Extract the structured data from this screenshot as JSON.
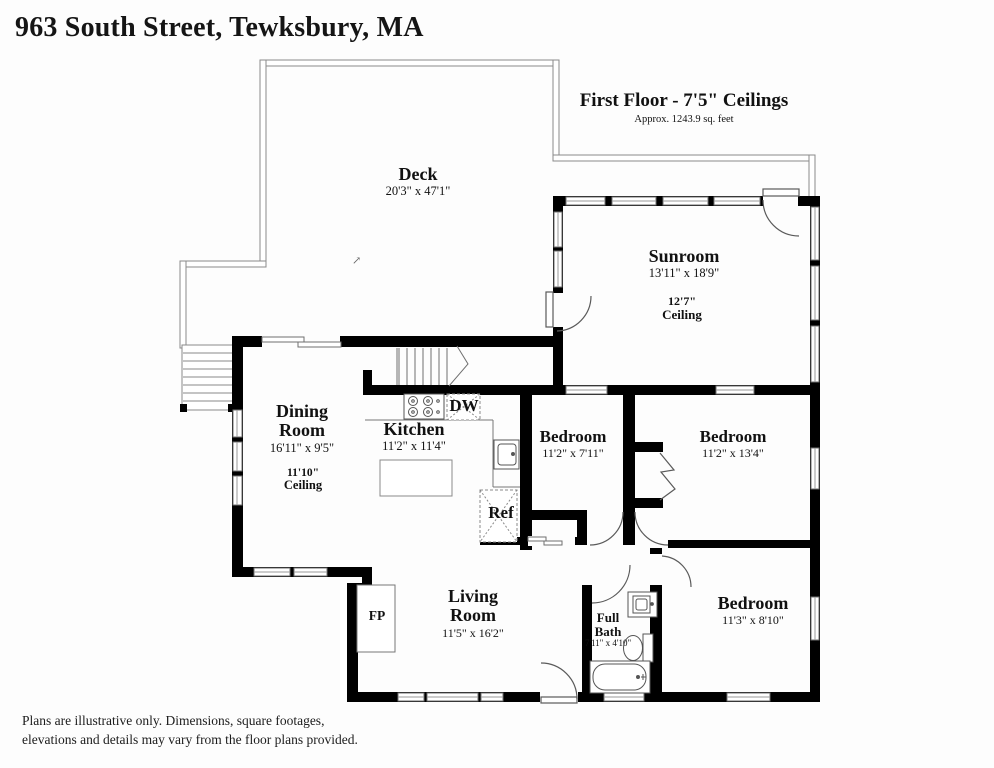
{
  "title": "963 South Street, Tewksbury, MA",
  "floor_header": {
    "line1": "First Floor - 7'5\" Ceilings",
    "line2": "Approx. 1243.9 sq. feet"
  },
  "rooms": {
    "deck": {
      "name": "Deck",
      "dims": "20'3\" x 47'1\""
    },
    "sunroom": {
      "name": "Sunroom",
      "dims": "13'11\" x 18'9\"",
      "ceiling_height": "12'7\"",
      "ceiling_label": "Ceiling"
    },
    "dining": {
      "name_line1": "Dining",
      "name_line2": "Room",
      "dims": "16'11\" x 9'5\"",
      "ceiling_height": "11'10\"",
      "ceiling_label": "Ceiling"
    },
    "kitchen": {
      "name": "Kitchen",
      "dims": "11'2\" x 11'4\""
    },
    "bedroom1": {
      "name": "Bedroom",
      "dims": "11'2\" x 7'11\""
    },
    "bedroom2": {
      "name": "Bedroom",
      "dims": "11'2\" x 13'4\""
    },
    "living": {
      "name_line1": "Living",
      "name_line2": "Room",
      "dims": "11'5\" x 16'2\""
    },
    "bath": {
      "name_line1": "Full",
      "name_line2": "Bath",
      "dims": "7'11\" x 4'10\""
    },
    "bedroom3": {
      "name": "Bedroom",
      "dims": "11'3\" x 8'10\""
    }
  },
  "fixtures": {
    "dishwasher": "DW",
    "refrigerator": "Ref",
    "fireplace": "FP"
  },
  "compass_mark": "↗",
  "disclaimer": {
    "line1": "Plans are illustrative only. Dimensions, square footages,",
    "line2": "elevations and details may vary from the floor plans provided."
  },
  "colors": {
    "wall": "#000000",
    "line": "#555555",
    "background": "#fdfdfd"
  }
}
